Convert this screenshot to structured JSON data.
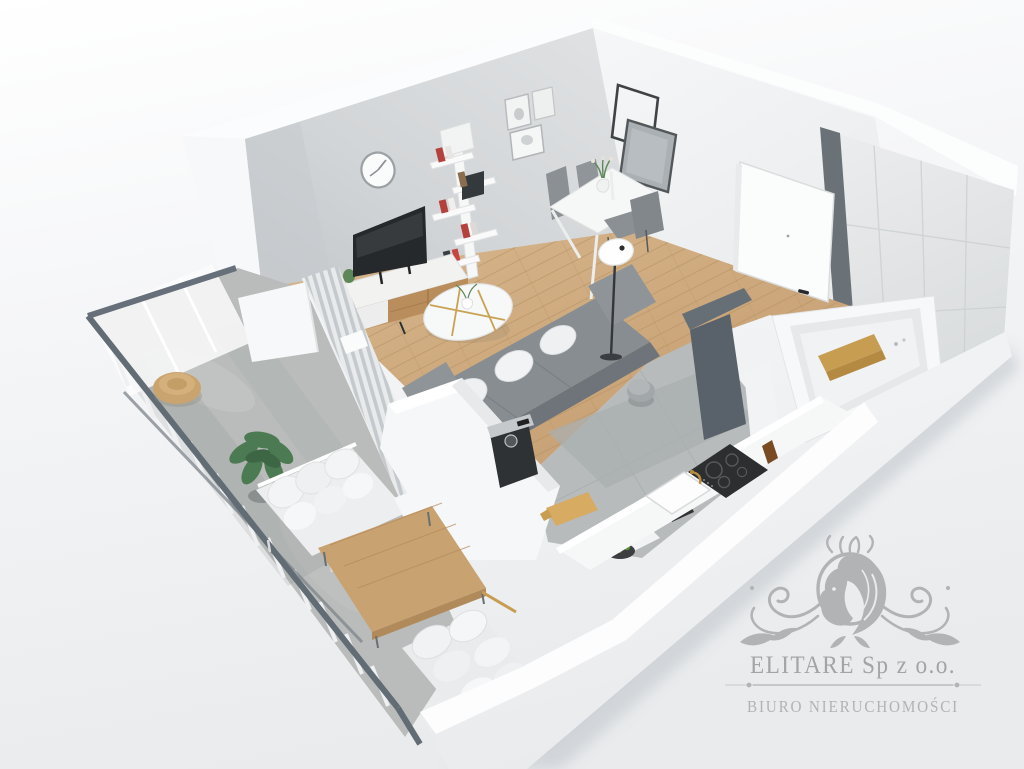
{
  "watermark": {
    "logo_icon": "lion-crest-icon",
    "company_name": "ELITARE Sp z o.o.",
    "tagline": "BIURO NIERUCHOMOŚCI",
    "company_color": "#a2a4a5",
    "tagline_color": "#b1b3b4",
    "emblem_color": "#b2b3b4"
  },
  "scene": {
    "description": "3D cutaway floor-plan render of a studio apartment with balcony",
    "rooms": [
      {
        "name": "living-room",
        "items": [
          "wall-clock",
          "tree-bookshelf",
          "picture-frames",
          "square-mirrors",
          "flat-tv",
          "tv-sideboard",
          "round-coffee-table",
          "gray-sofa",
          "floor-lamp",
          "area-rug",
          "vertical-blinds",
          "wood-floor"
        ]
      },
      {
        "name": "dining-area",
        "items": [
          "white-dining-table",
          "gray-chairs",
          "tulip-vase"
        ]
      },
      {
        "name": "kitchen",
        "items": [
          "white-counter",
          "induction-hob",
          "sink",
          "gold-faucet",
          "coffee-machine",
          "cutting-board",
          "fruit-bowl",
          "kettle",
          "tile-floor"
        ]
      },
      {
        "name": "hallway",
        "items": [
          "entry-door",
          "fluffy-stool"
        ]
      },
      {
        "name": "bathroom",
        "items": [
          "bathtub",
          "wooden-bath-caddy",
          "tiled-wall",
          "dark-partition"
        ]
      },
      {
        "name": "balcony",
        "items": [
          "glass-railing",
          "wicker-pouf",
          "potted-plant",
          "outdoor-bench",
          "pillow-lounge",
          "wooden-low-table",
          "concrete-floor"
        ]
      }
    ],
    "palette": {
      "wood_floor": "#cda87c",
      "concrete_floor": "#b9bcba",
      "wall_light_gray": "#d3d6d8",
      "wall_white": "#f4f5f6",
      "railing_dark": "#626c74",
      "sofa_gray": "#878d91",
      "accent_wood": "#c79d52",
      "plant_green": "#4c7a52",
      "tile": "#e6e8e9"
    }
  }
}
